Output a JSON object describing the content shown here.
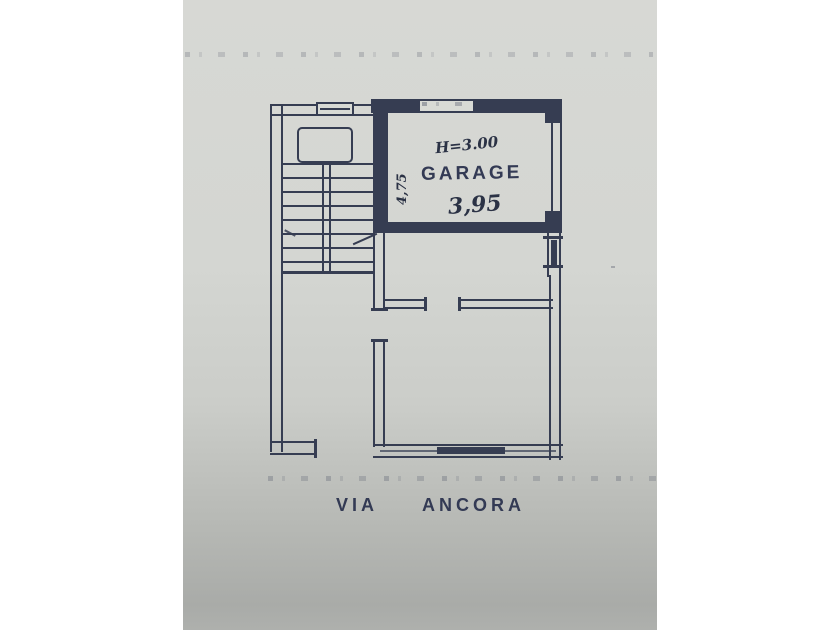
{
  "plan": {
    "garage_label": "GARAGE",
    "height_note": "H=3.00",
    "front_dimension": "3,95",
    "side_dimension": "4,75",
    "street": {
      "via": "VIA",
      "name": "ANCORA"
    }
  },
  "colors": {
    "ink": "#363d52",
    "handwriting": "#2b3245",
    "paper": "#d4d6d2",
    "paper_bottom": "#a9aba8"
  }
}
